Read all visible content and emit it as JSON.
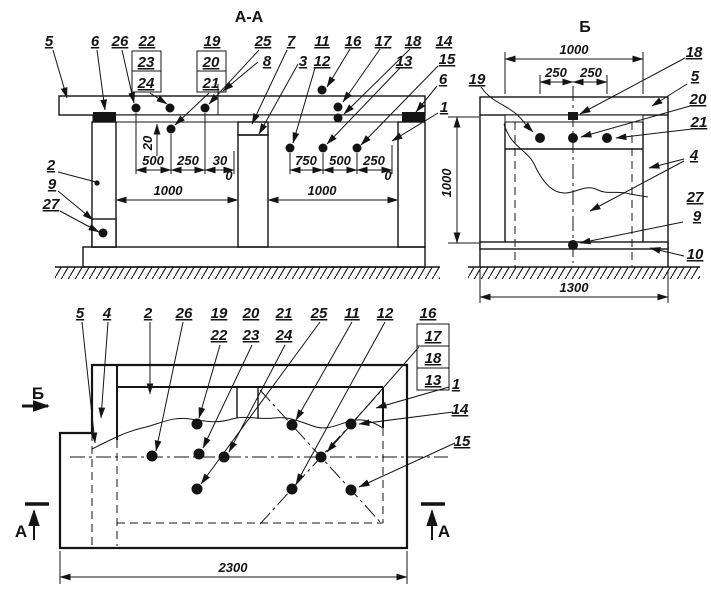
{
  "colors": {
    "ink": "#141414",
    "background": "#ffffff"
  },
  "aa": {
    "title": "А-А",
    "labels": {
      "n5": "5",
      "n6": "6",
      "n26": "26",
      "n22": "22",
      "n23": "23",
      "n24": "24",
      "n19": "19",
      "n20": "20",
      "n21": "21",
      "n25": "25",
      "n8": "8",
      "n7": "7",
      "n3": "3",
      "n11": "11",
      "n12": "12",
      "n16": "16",
      "n17": "17",
      "n18": "18",
      "n13": "13",
      "n14": "14",
      "n15": "15",
      "n6r": "6",
      "n1": "1",
      "n2": "2",
      "n9": "9",
      "n27": "27"
    },
    "dims": {
      "d20": "20",
      "d500": "500",
      "d250": "250",
      "d30": "30",
      "d0l": "0",
      "d1000l": "1000",
      "d750": "750",
      "d500r": "500",
      "d250r": "250",
      "d0r": "0",
      "d1000r": "1000",
      "d1000v": "1000"
    }
  },
  "b": {
    "title": "Б",
    "labels": {
      "n19": "19",
      "n18": "18",
      "n5": "5",
      "n20": "20",
      "n21": "21",
      "n4": "4",
      "n27": "27",
      "n9": "9",
      "n10": "10"
    },
    "dims": {
      "d1000": "1000",
      "d250a": "250",
      "d250b": "250",
      "d1300": "1300"
    }
  },
  "plan": {
    "labels": {
      "n5": "5",
      "n4": "4",
      "n2": "2",
      "n26": "26",
      "n19": "19",
      "n22": "22",
      "n20": "20",
      "n23": "23",
      "n21": "21",
      "n24": "24",
      "n25": "25",
      "n11": "11",
      "n12": "12",
      "n16": "16",
      "n17": "17",
      "n18": "18",
      "n13": "13",
      "n1": "1",
      "n14": "14",
      "n15": "15"
    },
    "dims": {
      "d2300": "2300"
    },
    "markers": {
      "b": "Б",
      "a_left": "А",
      "a_right": "А"
    }
  }
}
